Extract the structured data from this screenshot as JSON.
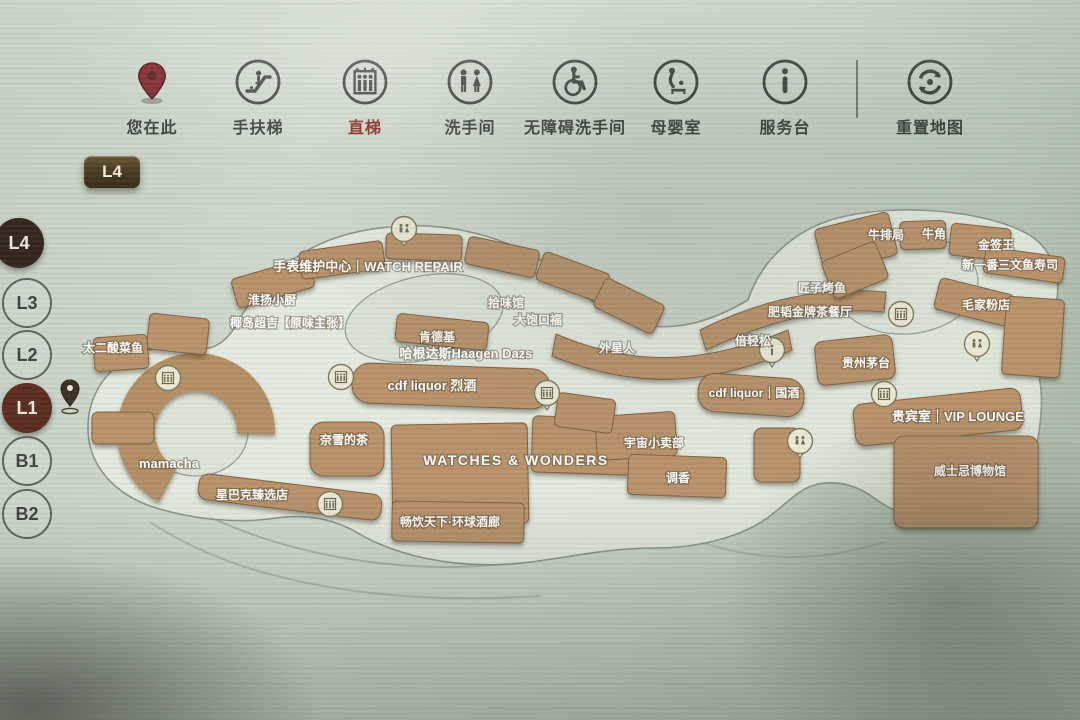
{
  "legend": {
    "items": [
      {
        "id": "you-are-here",
        "label": "您在此",
        "highlight": false
      },
      {
        "id": "escalator",
        "label": "手扶梯",
        "highlight": false
      },
      {
        "id": "elevator",
        "label": "直梯",
        "highlight": true
      },
      {
        "id": "restroom",
        "label": "洗手间",
        "highlight": false
      },
      {
        "id": "accessible-restroom",
        "label": "无障碍洗手间",
        "highlight": false
      },
      {
        "id": "nursing-room",
        "label": "母婴室",
        "highlight": false
      },
      {
        "id": "service-desk",
        "label": "服务台",
        "highlight": false
      }
    ],
    "reset_label": "重置地图"
  },
  "floor_tag": "L4",
  "floors": [
    {
      "label": "L4",
      "style": "dark",
      "y": 218
    },
    {
      "label": "L3",
      "style": "",
      "y": 278
    },
    {
      "label": "L2",
      "style": "",
      "y": 330
    },
    {
      "label": "L1",
      "style": "maroon",
      "y": 383
    },
    {
      "label": "B1",
      "style": "",
      "y": 436
    },
    {
      "label": "B2",
      "style": "",
      "y": 489
    }
  ],
  "map": {
    "stores": [
      {
        "text": "手表维护中心｜WATCH REPAIR",
        "x": 368,
        "y": 271,
        "size": 13
      },
      {
        "text": "淮扬小厨",
        "x": 272,
        "y": 304,
        "size": 12
      },
      {
        "text": "椰岛超吉【原味主张】",
        "x": 290,
        "y": 327,
        "size": 12
      },
      {
        "text": "太二酸菜鱼",
        "x": 113,
        "y": 352,
        "size": 12
      },
      {
        "text": "肯德基",
        "x": 437,
        "y": 341,
        "size": 12
      },
      {
        "text": "哈根达斯Haagen Dazs",
        "x": 466,
        "y": 358,
        "size": 13
      },
      {
        "text": "拾味馆",
        "x": 506,
        "y": 307,
        "size": 12
      },
      {
        "text": "大饱口福",
        "x": 538,
        "y": 324,
        "size": 12
      },
      {
        "text": "cdf liquor 烈酒",
        "x": 432,
        "y": 390,
        "size": 13
      },
      {
        "text": "奈雪的茶",
        "x": 344,
        "y": 444,
        "size": 12
      },
      {
        "text": "外星人",
        "x": 617,
        "y": 352,
        "size": 12
      },
      {
        "text": "倍轻松",
        "x": 753,
        "y": 345,
        "size": 12
      },
      {
        "text": "匠子烤鱼",
        "x": 822,
        "y": 292,
        "size": 12
      },
      {
        "text": "肥韬金牌茶餐厅",
        "x": 810,
        "y": 316,
        "size": 12
      },
      {
        "text": "牛排局",
        "x": 886,
        "y": 239,
        "size": 12
      },
      {
        "text": "牛角",
        "x": 934,
        "y": 238,
        "size": 12
      },
      {
        "text": "金签王",
        "x": 996,
        "y": 249,
        "size": 12
      },
      {
        "text": "新一番三文鱼寿司",
        "x": 1010,
        "y": 269,
        "size": 12
      },
      {
        "text": "毛家粉店",
        "x": 986,
        "y": 309,
        "size": 12
      },
      {
        "text": "贵州茅台",
        "x": 866,
        "y": 367,
        "size": 12
      },
      {
        "text": "cdf liquor｜国酒",
        "x": 754,
        "y": 397,
        "size": 12
      },
      {
        "text": "贵宾室｜VIP LOUNGE",
        "x": 958,
        "y": 421,
        "size": 13
      },
      {
        "text": "威士忌博物馆",
        "x": 970,
        "y": 475,
        "size": 12
      },
      {
        "text": "宇宙小卖部",
        "x": 654,
        "y": 447,
        "size": 12
      },
      {
        "text": "调香",
        "x": 678,
        "y": 482,
        "size": 12
      },
      {
        "text": "WATCHES & WONDERS",
        "x": 516,
        "y": 465,
        "size": 14,
        "spacing": 1.5
      },
      {
        "text": "星巴克臻选店",
        "x": 252,
        "y": 499,
        "size": 12
      },
      {
        "text": "mamacha",
        "x": 169,
        "y": 468,
        "size": 13
      },
      {
        "text": "畅饮天下·环球酒廊",
        "x": 450,
        "y": 526,
        "size": 12
      }
    ],
    "facility_icons": [
      {
        "type": "restroom",
        "x": 404,
        "y": 229,
        "pin": true
      },
      {
        "type": "elevator",
        "x": 168,
        "y": 378,
        "pin": false
      },
      {
        "type": "elevator",
        "x": 341,
        "y": 377,
        "pin": false
      },
      {
        "type": "elevator",
        "x": 547,
        "y": 393,
        "pin": true
      },
      {
        "type": "service",
        "x": 772,
        "y": 350,
        "pin": true
      },
      {
        "type": "restroom",
        "x": 977,
        "y": 344,
        "pin": true
      },
      {
        "type": "elevator",
        "x": 884,
        "y": 394,
        "pin": false
      },
      {
        "type": "elevator",
        "x": 901,
        "y": 314,
        "pin": false
      },
      {
        "type": "restroom",
        "x": 800,
        "y": 441,
        "pin": true
      },
      {
        "type": "elevator",
        "x": 330,
        "y": 504,
        "pin": false
      }
    ],
    "you_are_here": {
      "x": 70,
      "y": 390
    }
  },
  "colors": {
    "background": "#c8d2c8",
    "block_tan": "#b8916a",
    "block_edge": "#7e6142",
    "floor_selected_dark": "#33241d",
    "floor_selected_maroon": "#5b2b1f",
    "pin_red": "#7c1f24",
    "legend_highlight": "#8a2a1e",
    "map_surface": "#e3e8df"
  }
}
